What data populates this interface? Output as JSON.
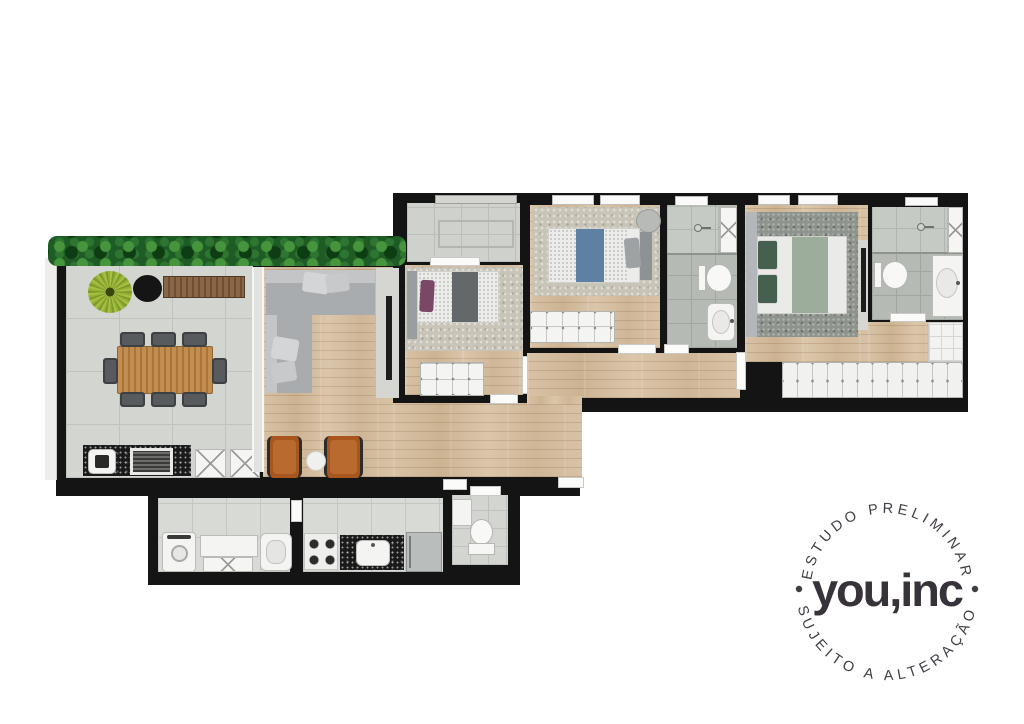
{
  "stamp": {
    "arc_top_text": "ESTUDO PRELIMINAR",
    "arc_bottom_text": "SUJEITO A ALTERAÇÃO",
    "logo_text": "you,inc",
    "text_color": "#423c44",
    "logo_color": "#38323a"
  },
  "floorplan": {
    "type": "apartment-floor-plan-render",
    "wall_color": "#141414",
    "colors": {
      "wood_floor": "#d4bda0",
      "concrete_tile": "#d3d5d1",
      "kitchen_tile": "#d8dad6",
      "bath_tile": "#b5bab4",
      "hedge_green": "#1e5b25",
      "sofa_gray": "#a9acae",
      "leather_chair": "#a8561e",
      "dining_table_wood": "#c28d4e",
      "master_rug": "#8e938e",
      "bedroom_rug": "#c9c4b8",
      "accent_blue_bedding": "#5e80a3",
      "accent_purple_pillow": "#7a4765",
      "accent_sage_bedding": "#9dad9b"
    },
    "icons": [
      {
        "name": "hedge-plants-icon",
        "depicts": "green shrub band on terrace edge"
      },
      {
        "name": "potted-plant-icon",
        "depicts": "round leafy plant"
      },
      {
        "name": "dining-table-icon",
        "depicts": "8-seat wood dining table"
      },
      {
        "name": "grill-icon",
        "depicts": "built-in barbecue grate"
      },
      {
        "name": "sofa-icon",
        "depicts": "L-shaped sectional sofa"
      },
      {
        "name": "tv-icon",
        "depicts": "wall TV panels"
      },
      {
        "name": "bed-icon",
        "depicts": "single and double beds"
      },
      {
        "name": "toilet-icon",
        "depicts": "toilets"
      },
      {
        "name": "shower-icon",
        "depicts": "shower heads"
      },
      {
        "name": "sink-icon",
        "depicts": "washbasins"
      },
      {
        "name": "stove-icon",
        "depicts": "4-burner cooktop"
      },
      {
        "name": "fridge-icon",
        "depicts": "refrigerator"
      },
      {
        "name": "washer-icon",
        "depicts": "washing machine"
      },
      {
        "name": "wardrobe-icon",
        "depicts": "closet wardrobes and dressers"
      }
    ]
  }
}
